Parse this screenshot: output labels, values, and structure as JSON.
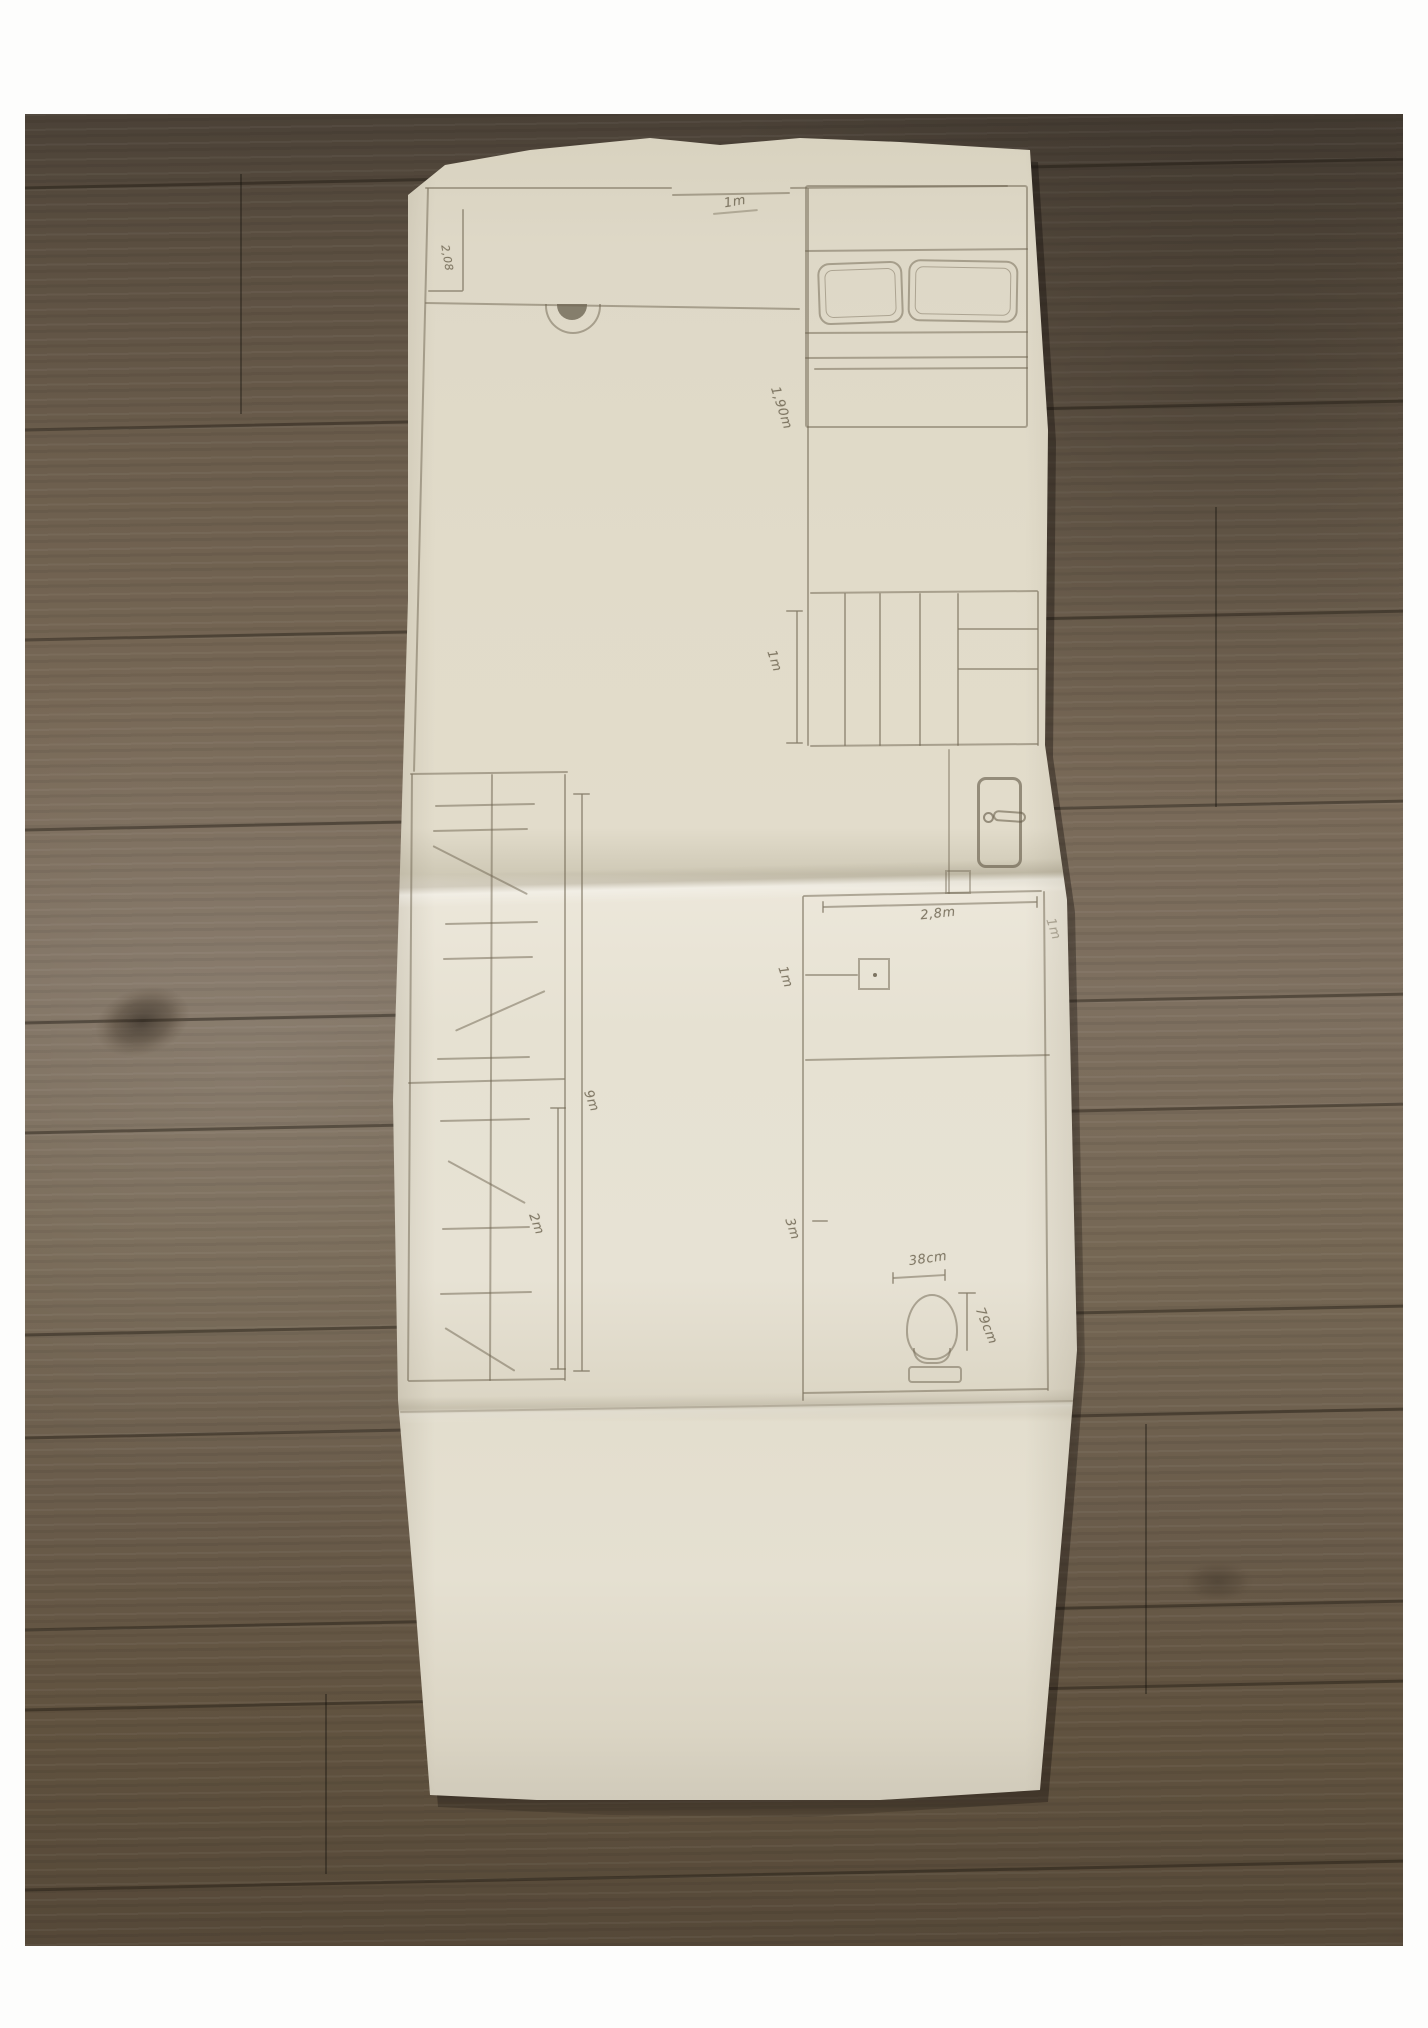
{
  "photo": {
    "background": "wood-plank-floor",
    "wood_color": "#6b5e4e",
    "paper_color": "#e4dfcf",
    "pencil_color": "#6e6450"
  },
  "sketch": {
    "type": "hand-drawn floor plan, pencil on folded paper",
    "labels": [
      {
        "id": "opening-width",
        "text": "1m",
        "x": 345,
        "y": 74,
        "rot": -10
      },
      {
        "id": "room-height-left",
        "text": "2,08",
        "x": 57,
        "y": 130,
        "rot": 80,
        "size": 11
      },
      {
        "id": "bed-length",
        "text": "1,90m",
        "x": 391,
        "y": 280,
        "rot": 72
      },
      {
        "id": "closet-width",
        "text": "1m",
        "x": 384,
        "y": 533,
        "rot": 72
      },
      {
        "id": "wall-length",
        "text": "9m",
        "x": 201,
        "y": 973,
        "rot": 70
      },
      {
        "id": "closet-depth",
        "text": "2m",
        "x": 146,
        "y": 1096,
        "rot": 70
      },
      {
        "id": "room-width",
        "text": "2,8m",
        "x": 548,
        "y": 786,
        "rot": -6
      },
      {
        "id": "wall-seg-left",
        "text": "1m",
        "x": 395,
        "y": 849,
        "rot": 72
      },
      {
        "id": "wall-seg-right",
        "text": "1m",
        "x": 663,
        "y": 801,
        "rot": 72,
        "o": 0.5
      },
      {
        "id": "room-depth",
        "text": "3m",
        "x": 402,
        "y": 1101,
        "rot": 72
      },
      {
        "id": "toilet-width",
        "text": "38cm",
        "x": 538,
        "y": 1131,
        "rot": -8
      },
      {
        "id": "toilet-depth",
        "text": "79cm",
        "x": 596,
        "y": 1198,
        "rot": 68
      }
    ],
    "segments": [
      {
        "x1": 35,
        "y1": 59,
        "x2": 282,
        "y2": 59
      },
      {
        "x1": 282,
        "y1": 66,
        "x2": 400,
        "y2": 64
      },
      {
        "x1": 400,
        "y1": 59,
        "x2": 618,
        "y2": 57
      },
      {
        "x1": 38,
        "y1": 59,
        "x2": 24,
        "y2": 643
      },
      {
        "x1": 73,
        "y1": 80,
        "x2": 73,
        "y2": 162
      },
      {
        "x1": 38,
        "y1": 162,
        "x2": 73,
        "y2": 162
      },
      {
        "x1": 35,
        "y1": 174,
        "x2": 410,
        "y2": 180
      },
      {
        "x1": 418,
        "y1": 59,
        "x2": 418,
        "y2": 617
      },
      {
        "x1": 323,
        "y1": 85,
        "x2": 368,
        "y2": 81,
        "o": 0.45
      },
      {
        "x1": 415,
        "y1": 122,
        "x2": 638,
        "y2": 120
      },
      {
        "x1": 415,
        "y1": 204,
        "x2": 638,
        "y2": 203
      },
      {
        "x1": 415,
        "y1": 229,
        "x2": 638,
        "y2": 228
      },
      {
        "x1": 424,
        "y1": 240,
        "x2": 638,
        "y2": 239
      },
      {
        "x1": 420,
        "y1": 464,
        "x2": 648,
        "y2": 462
      },
      {
        "x1": 648,
        "y1": 462,
        "x2": 648,
        "y2": 617
      },
      {
        "x1": 420,
        "y1": 617,
        "x2": 648,
        "y2": 615
      },
      {
        "x1": 455,
        "y1": 464,
        "x2": 455,
        "y2": 617
      },
      {
        "x1": 490,
        "y1": 464,
        "x2": 490,
        "y2": 617
      },
      {
        "x1": 530,
        "y1": 464,
        "x2": 530,
        "y2": 617
      },
      {
        "x1": 568,
        "y1": 464,
        "x2": 568,
        "y2": 617
      },
      {
        "x1": 568,
        "y1": 500,
        "x2": 648,
        "y2": 500
      },
      {
        "x1": 568,
        "y1": 540,
        "x2": 648,
        "y2": 540
      },
      {
        "x1": 407,
        "y1": 482,
        "x2": 407,
        "y2": 614
      },
      {
        "x1": 396,
        "y1": 482,
        "x2": 413,
        "y2": 482
      },
      {
        "x1": 396,
        "y1": 614,
        "x2": 413,
        "y2": 614
      },
      {
        "x1": 559,
        "y1": 620,
        "x2": 559,
        "y2": 765,
        "o": 0.45
      },
      {
        "x1": 20,
        "y1": 645,
        "x2": 178,
        "y2": 643
      },
      {
        "x1": 22,
        "y1": 645,
        "x2": 18,
        "y2": 1252
      },
      {
        "x1": 102,
        "y1": 645,
        "x2": 100,
        "y2": 1252
      },
      {
        "x1": 175,
        "y1": 645,
        "x2": 175,
        "y2": 1252
      },
      {
        "x1": 18,
        "y1": 1252,
        "x2": 175,
        "y2": 1250
      },
      {
        "x1": 18,
        "y1": 954,
        "x2": 175,
        "y2": 950
      },
      {
        "x1": 45,
        "y1": 677,
        "x2": 145,
        "y2": 675
      },
      {
        "x1": 43,
        "y1": 702,
        "x2": 138,
        "y2": 700
      },
      {
        "x1": 43,
        "y1": 717,
        "x2": 137,
        "y2": 765
      },
      {
        "x1": 55,
        "y1": 795,
        "x2": 148,
        "y2": 793
      },
      {
        "x1": 53,
        "y1": 830,
        "x2": 143,
        "y2": 828
      },
      {
        "x1": 155,
        "y1": 862,
        "x2": 65,
        "y2": 902
      },
      {
        "x1": 47,
        "y1": 930,
        "x2": 140,
        "y2": 928
      },
      {
        "x1": 50,
        "y1": 992,
        "x2": 140,
        "y2": 990
      },
      {
        "x1": 58,
        "y1": 1032,
        "x2": 135,
        "y2": 1074
      },
      {
        "x1": 52,
        "y1": 1100,
        "x2": 140,
        "y2": 1098
      },
      {
        "x1": 50,
        "y1": 1165,
        "x2": 142,
        "y2": 1163
      },
      {
        "x1": 55,
        "y1": 1199,
        "x2": 125,
        "y2": 1242
      },
      {
        "x1": 192,
        "y1": 665,
        "x2": 192,
        "y2": 1242
      },
      {
        "x1": 183,
        "y1": 665,
        "x2": 200,
        "y2": 665
      },
      {
        "x1": 183,
        "y1": 1242,
        "x2": 200,
        "y2": 1242
      },
      {
        "x1": 168,
        "y1": 979,
        "x2": 168,
        "y2": 1240
      },
      {
        "x1": 160,
        "y1": 979,
        "x2": 176,
        "y2": 979
      },
      {
        "x1": 160,
        "y1": 1240,
        "x2": 176,
        "y2": 1240
      },
      {
        "x1": 413,
        "y1": 767,
        "x2": 652,
        "y2": 762
      },
      {
        "x1": 433,
        "y1": 778,
        "x2": 647,
        "y2": 773
      },
      {
        "x1": 433,
        "y1": 772,
        "x2": 433,
        "y2": 784
      },
      {
        "x1": 647,
        "y1": 767,
        "x2": 647,
        "y2": 779
      },
      {
        "x1": 413,
        "y1": 767,
        "x2": 413,
        "y2": 1272
      },
      {
        "x1": 654,
        "y1": 762,
        "x2": 658,
        "y2": 1262
      },
      {
        "x1": 415,
        "y1": 931,
        "x2": 660,
        "y2": 926
      },
      {
        "x1": 413,
        "y1": 1264,
        "x2": 658,
        "y2": 1260
      },
      {
        "x1": 10,
        "y1": 1283,
        "x2": 685,
        "y2": 1272,
        "o": 0.3
      },
      {
        "x1": 415,
        "y1": 846,
        "x2": 468,
        "y2": 846
      },
      {
        "x1": 422,
        "y1": 1092,
        "x2": 438,
        "y2": 1092
      },
      {
        "x1": 503,
        "y1": 1149,
        "x2": 555,
        "y2": 1146
      },
      {
        "x1": 503,
        "y1": 1143,
        "x2": 503,
        "y2": 1155
      },
      {
        "x1": 555,
        "y1": 1140,
        "x2": 555,
        "y2": 1152
      },
      {
        "x1": 577,
        "y1": 1164,
        "x2": 577,
        "y2": 1222
      },
      {
        "x1": 568,
        "y1": 1164,
        "x2": 586,
        "y2": 1164
      }
    ]
  }
}
